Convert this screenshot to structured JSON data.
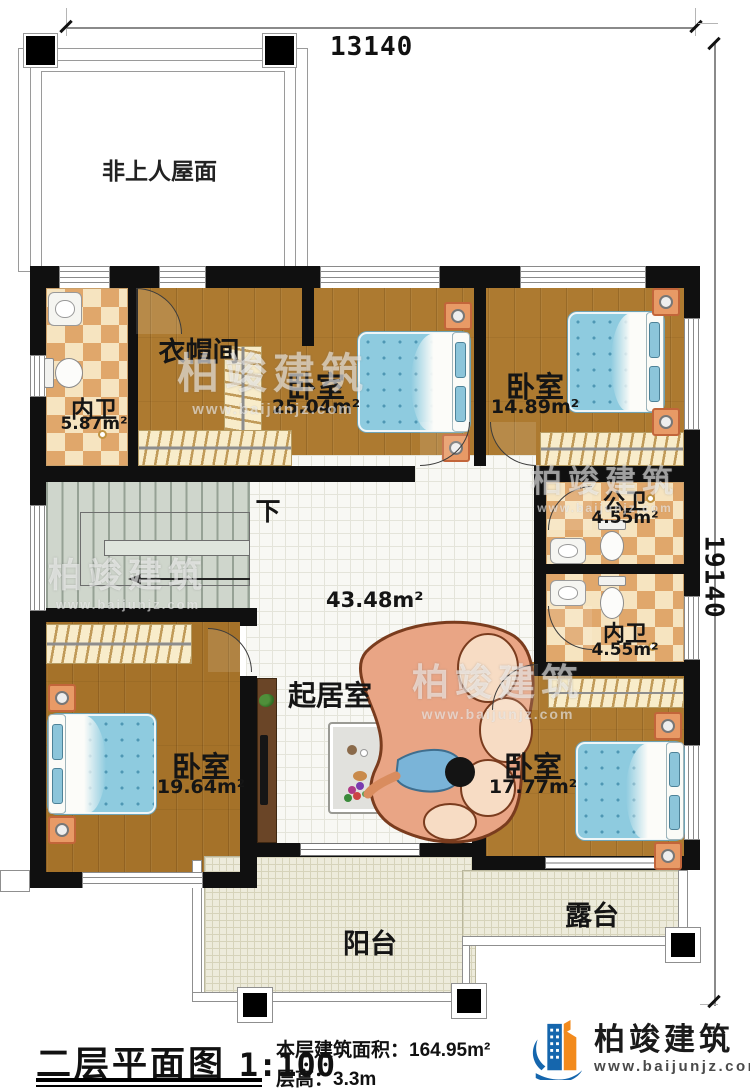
{
  "dimensions": {
    "top": "13140",
    "right": "19140"
  },
  "roof": {
    "label": "非上人屋面"
  },
  "rooms": {
    "bath_top": {
      "name": "内卫",
      "area": "5.87m²"
    },
    "cloakroom": {
      "name": "衣帽间"
    },
    "bedroom_top": {
      "name": "卧室",
      "area": "25.04m²"
    },
    "bedroom_topright": {
      "name": "卧室",
      "area": "14.89m²"
    },
    "bath_public": {
      "name": "公卫",
      "area": "4.55m²"
    },
    "bath_inner": {
      "name": "内卫",
      "area": "4.55m²"
    },
    "stairs": {
      "label": "下"
    },
    "living": {
      "name": "起居室",
      "area": "43.48m²"
    },
    "bedroom_left": {
      "name": "卧室",
      "area": "19.64m²"
    },
    "bedroom_right": {
      "name": "卧室",
      "area": "17.77m²"
    },
    "balcony": {
      "name": "阳台"
    },
    "terrace": {
      "name": "露台"
    }
  },
  "footer": {
    "plan_title": "二层平面图",
    "scale": "1:100",
    "area_label": "本层建筑面积：",
    "area_value": "164.95m²",
    "height_label": "层高：",
    "height_value": "3.3m"
  },
  "brand": {
    "name": "柏竣建筑",
    "url": "www.baijunjz.com"
  },
  "watermark": {
    "text": "柏竣建筑",
    "url": "www.baijunjz.com"
  },
  "colors": {
    "wall": "#101010",
    "wood": "#ad7a30",
    "checker_light": "#f6e4c0",
    "checker_dark": "#e0a76b",
    "bed_blue": "#8ecbdf",
    "balcony_floor": "#edebdb",
    "brand_blue": "#1566ad",
    "brand_orange": "#f28a1d"
  }
}
